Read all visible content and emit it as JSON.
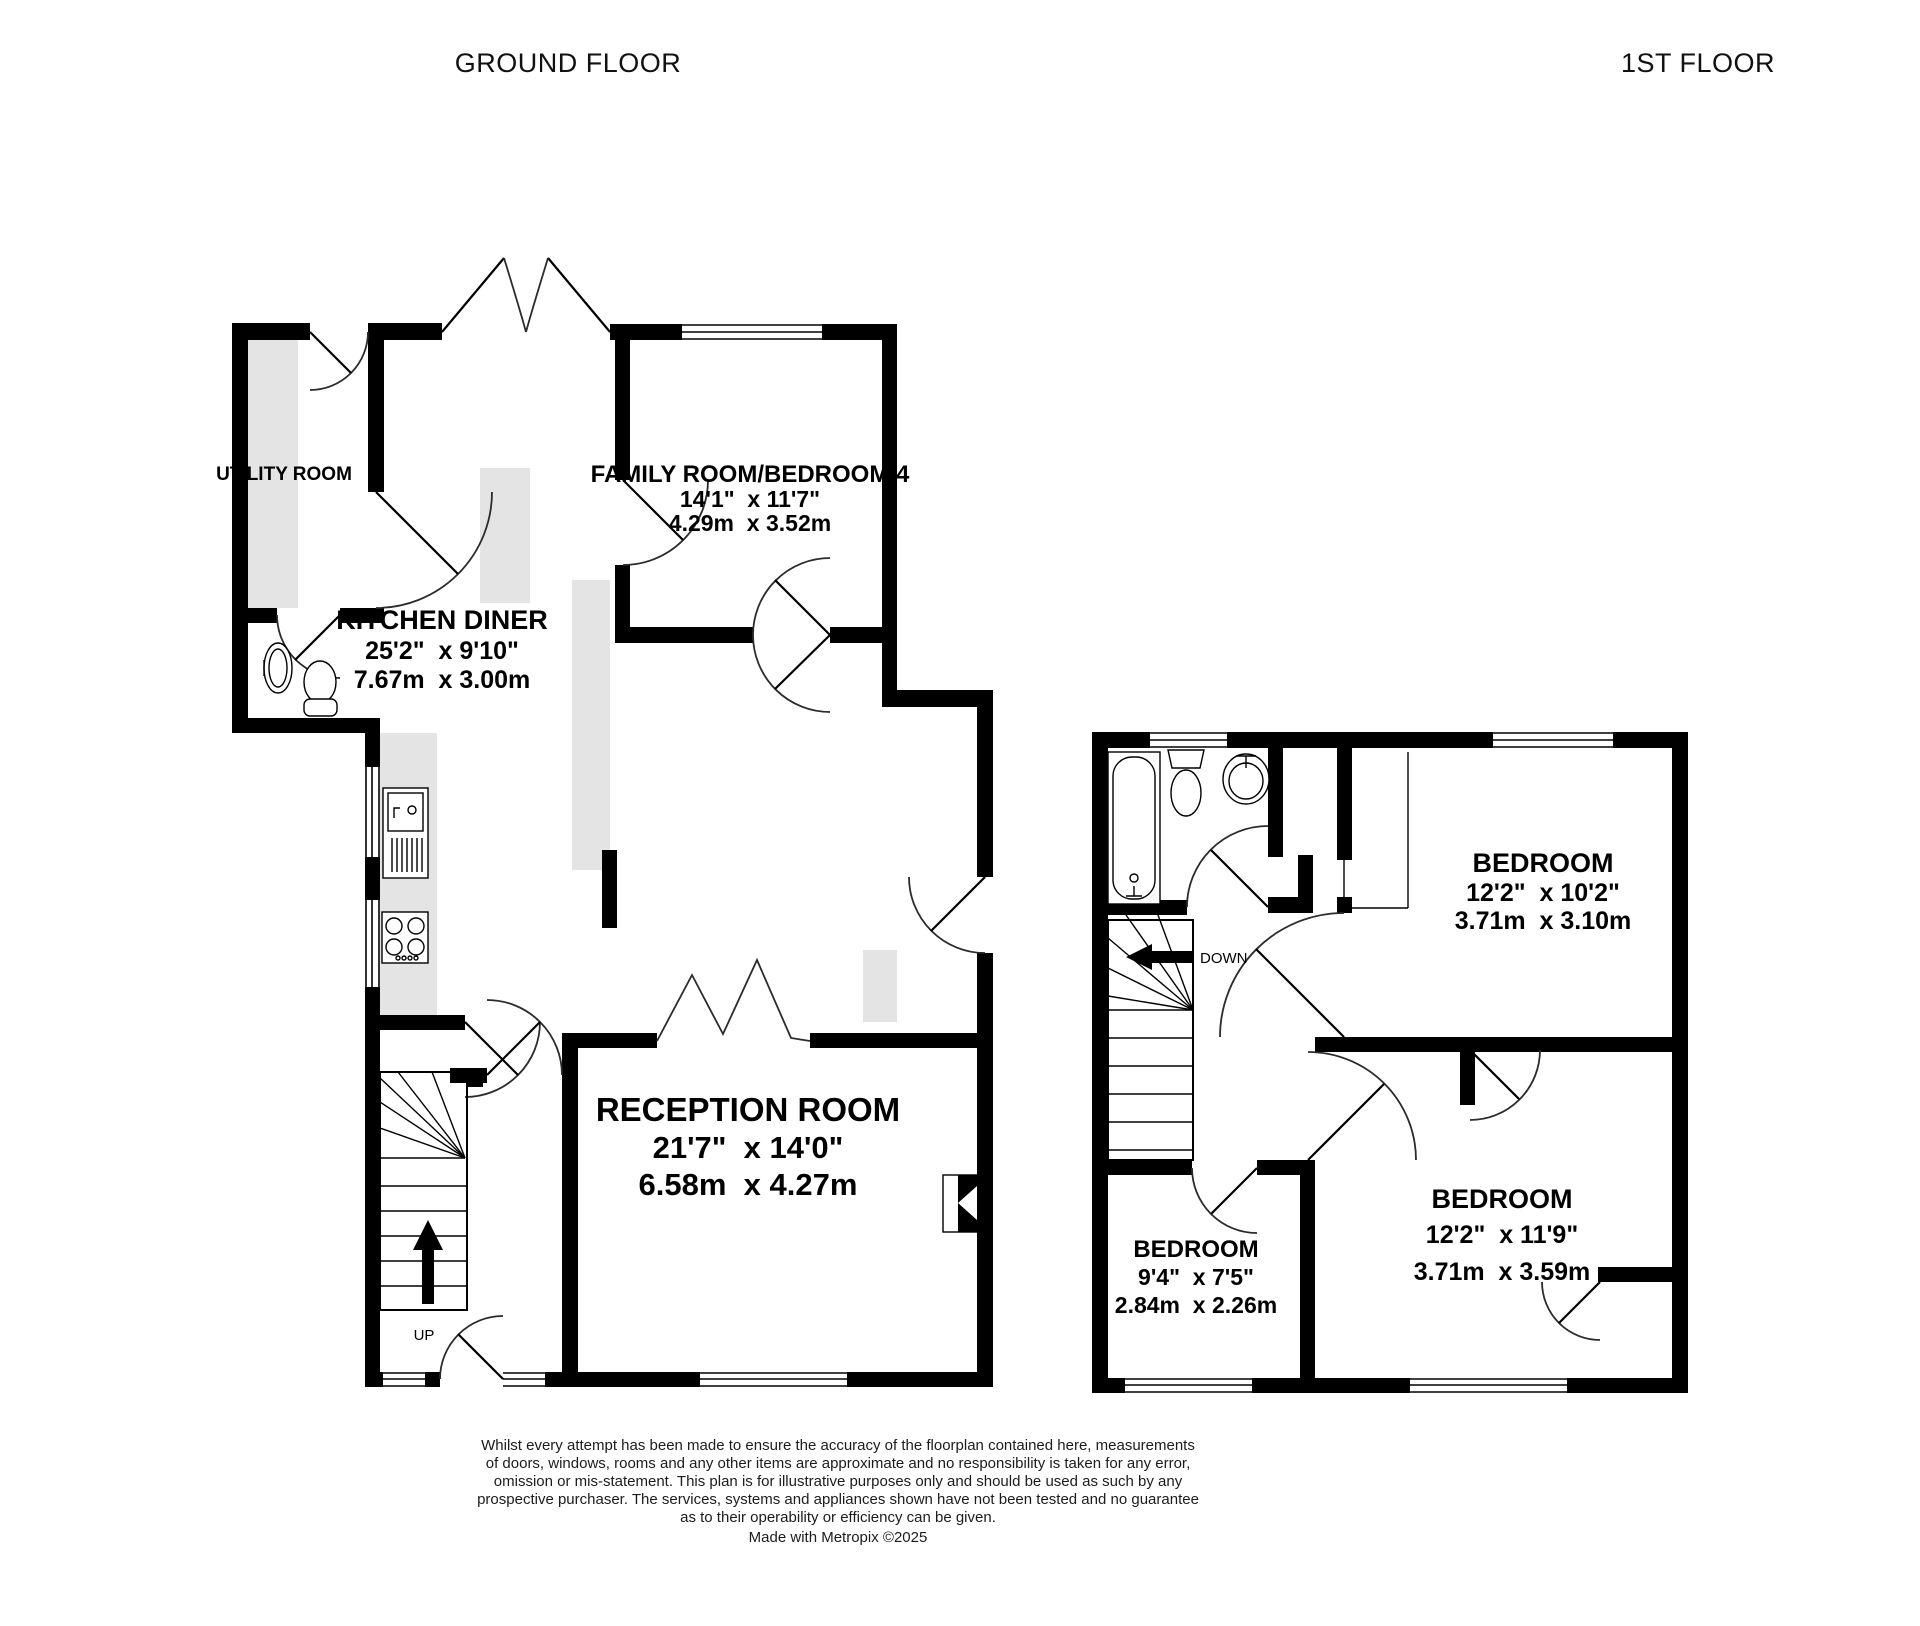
{
  "colors": {
    "background": "#ffffff",
    "wall": "#000000",
    "counter": "#e4e4e4",
    "text": "#000000"
  },
  "floors": {
    "ground": {
      "title": "GROUND FLOOR",
      "stairs_label": "UP",
      "rooms": {
        "utility": {
          "name": "UTILITY ROOM"
        },
        "kitchen": {
          "name": "KITCHEN DINER",
          "imperial": "25'2\"  x 9'10\"",
          "metric": "7.67m  x 3.00m"
        },
        "family": {
          "name": "FAMILY ROOM/BEDROOM 4",
          "imperial": "14'1\"  x 11'7\"",
          "metric": "4.29m  x 3.52m"
        },
        "reception": {
          "name": "RECEPTION ROOM",
          "imperial": "21'7\"  x 14'0\"",
          "metric": "6.58m  x 4.27m"
        }
      }
    },
    "first": {
      "title": "1ST FLOOR",
      "stairs_label": "DOWN",
      "rooms": {
        "bedroom1": {
          "name": "BEDROOM",
          "imperial": "12'2\"  x 10'2\"",
          "metric": "3.71m  x 3.10m"
        },
        "bedroom2": {
          "name": "BEDROOM",
          "imperial": "9'4\"  x 7'5\"",
          "metric": "2.84m  x 2.26m"
        },
        "bedroom3": {
          "name": "BEDROOM",
          "imperial": "12'2\"  x 11'9\"",
          "metric": "3.71m  x 3.59m"
        }
      }
    }
  },
  "disclaimer": {
    "lines": [
      "Whilst every attempt has been made to ensure the accuracy of the floorplan contained here, measurements",
      "of doors, windows, rooms and any other items are approximate and no responsibility is taken for any error,",
      "omission or mis-statement. This plan is for illustrative purposes only and should be used as such by any",
      "prospective purchaser. The services, systems and appliances shown have not been tested and no guarantee",
      "as to their operability or efficiency can be given.",
      "Made with Metropix ©2025"
    ]
  }
}
